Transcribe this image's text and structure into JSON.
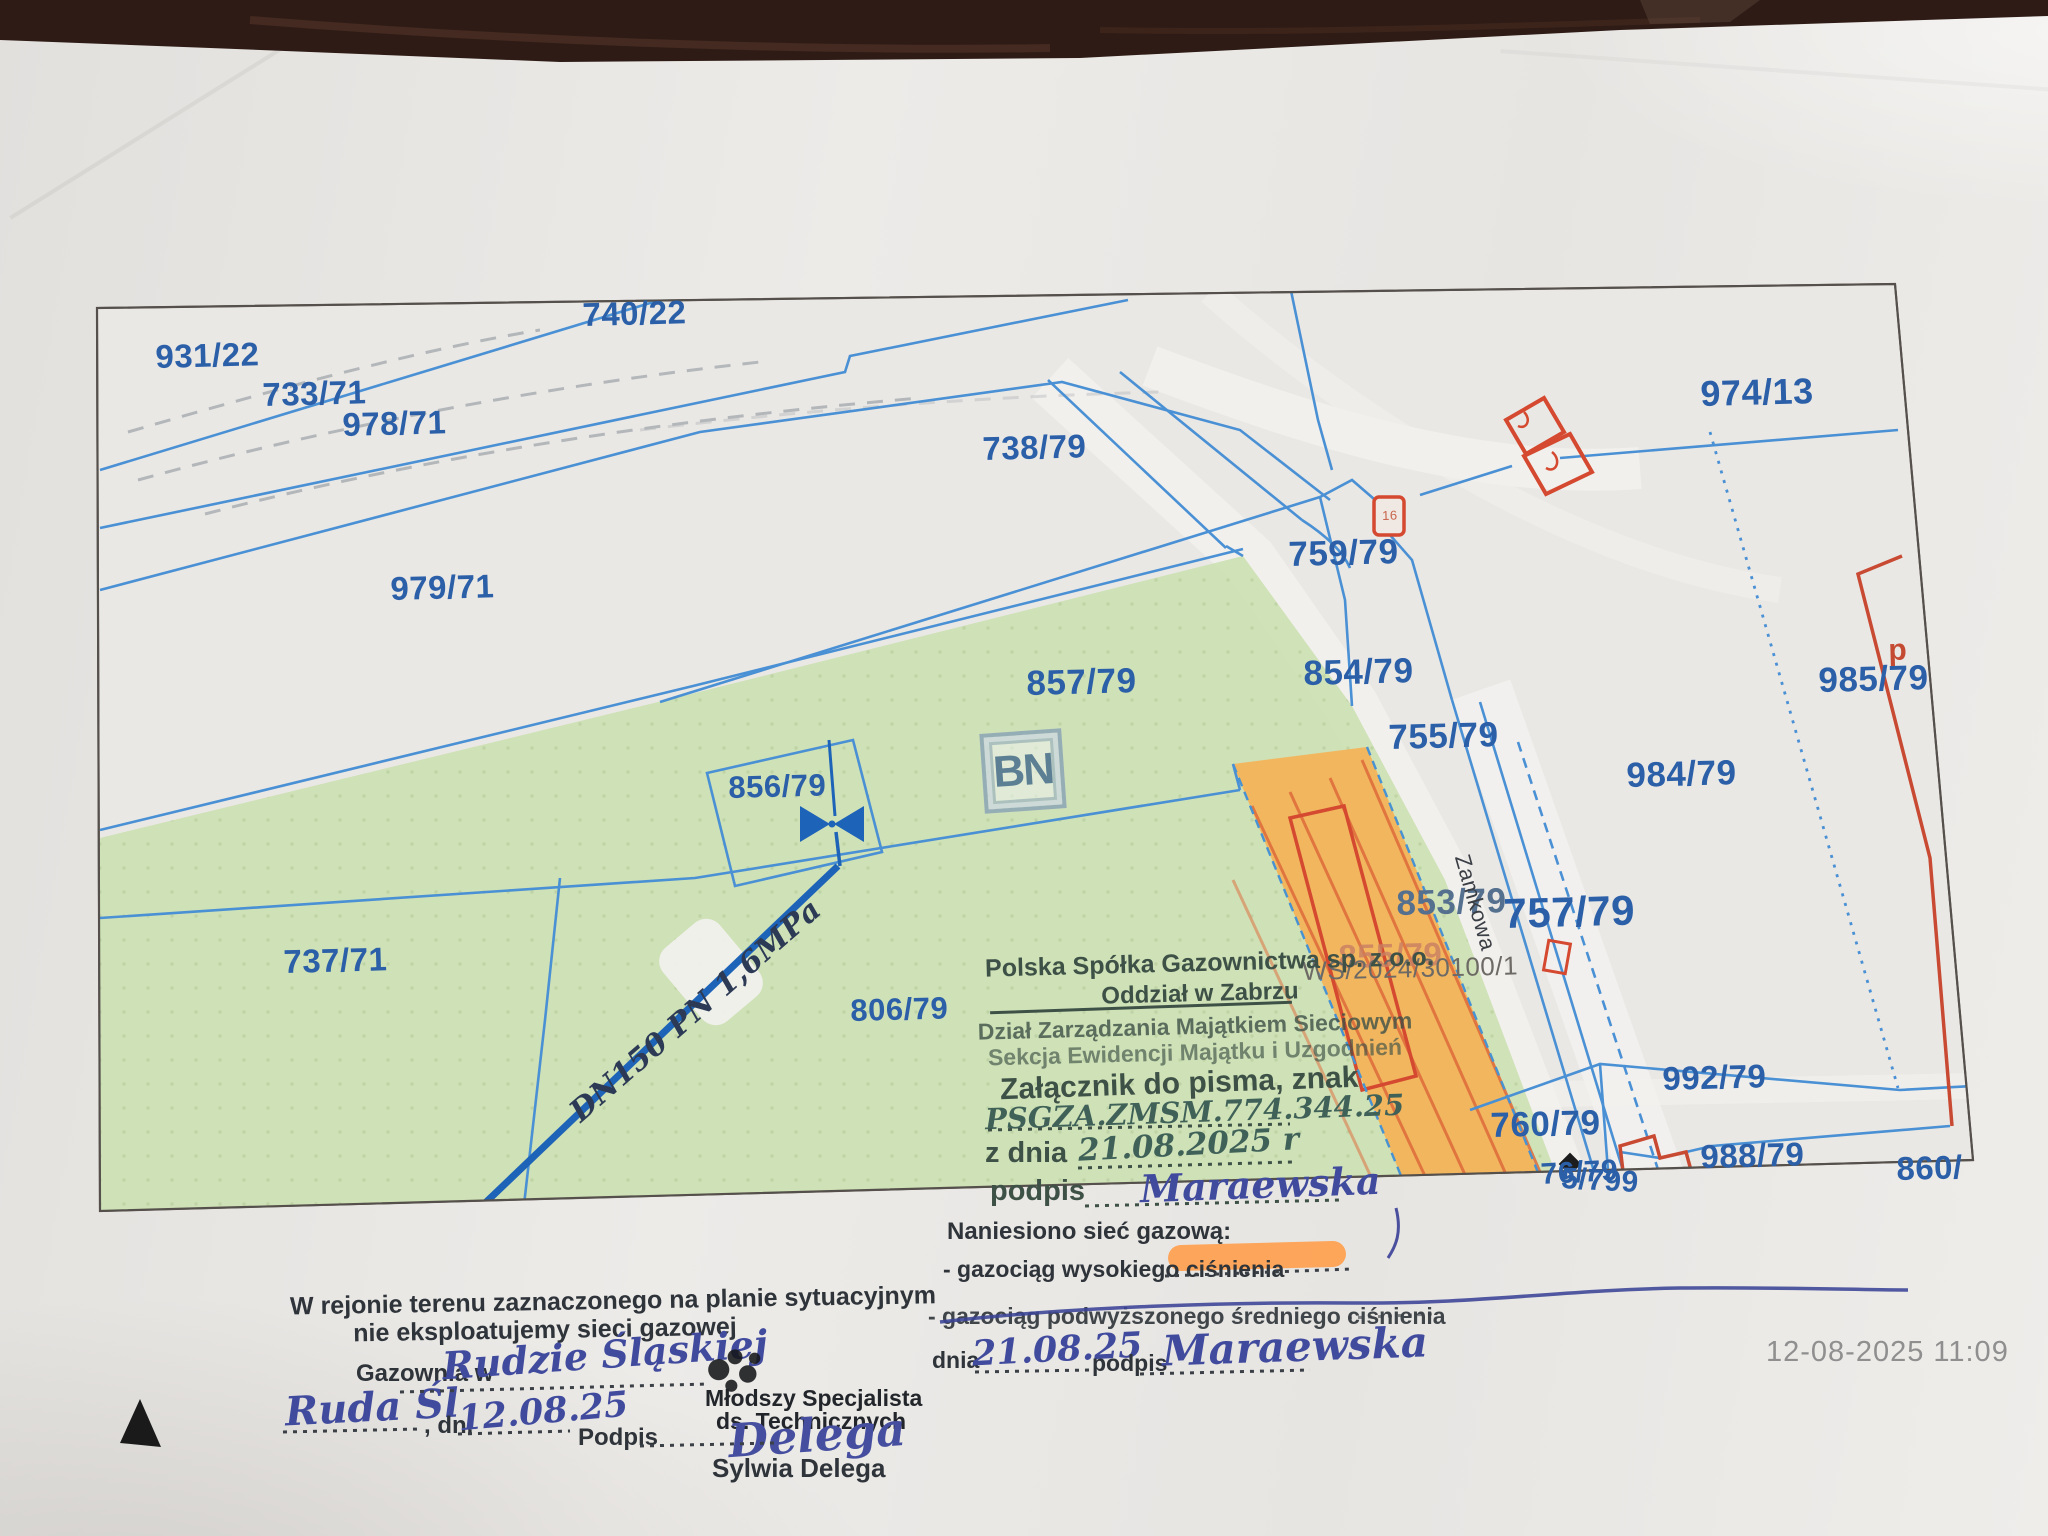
{
  "photo": {
    "timestamp": "12-08-2025 11:09"
  },
  "map": {
    "watermark": "BN",
    "colors": {
      "parcel_line": "#4a90d4",
      "parcel_label": "#2b5fa8",
      "green_area": "#cde0b4",
      "orange_area": "#f3b55c",
      "building_red": "#d4492f",
      "pipeline_blue": "#1d64b8",
      "highlighter": "#ff9d4a"
    },
    "labels": [
      {
        "name": "parcel-931-22",
        "text": "931/22",
        "x": 155,
        "y": 340,
        "size": 33
      },
      {
        "name": "parcel-733-71",
        "text": "733/71",
        "x": 262,
        "y": 378,
        "size": 33
      },
      {
        "name": "parcel-978-71",
        "text": "978/71",
        "x": 342,
        "y": 408,
        "size": 33
      },
      {
        "name": "parcel-740-22",
        "text": "740/22",
        "x": 582,
        "y": 298,
        "size": 33
      },
      {
        "name": "parcel-738-79",
        "text": "738/79",
        "x": 982,
        "y": 432,
        "size": 33
      },
      {
        "name": "parcel-979-71",
        "text": "979/71",
        "x": 390,
        "y": 572,
        "size": 33
      },
      {
        "name": "parcel-857-79",
        "text": "857/79",
        "x": 1026,
        "y": 666,
        "size": 35
      },
      {
        "name": "parcel-759-79",
        "text": "759/79",
        "x": 1288,
        "y": 537,
        "size": 35
      },
      {
        "name": "parcel-854-79",
        "text": "854/79",
        "x": 1303,
        "y": 656,
        "size": 35
      },
      {
        "name": "parcel-755-79",
        "text": "755/79",
        "x": 1388,
        "y": 720,
        "size": 35
      },
      {
        "name": "parcel-974-13",
        "text": "974/13",
        "x": 1700,
        "y": 376,
        "size": 36
      },
      {
        "name": "parcel-985-79",
        "text": "985/79",
        "x": 1818,
        "y": 663,
        "size": 35
      },
      {
        "name": "parcel-984-79",
        "text": "984/79",
        "x": 1626,
        "y": 758,
        "size": 35
      },
      {
        "name": "parcel-856-79",
        "text": "856/79",
        "x": 728,
        "y": 772,
        "size": 31
      },
      {
        "name": "parcel-737-71",
        "text": "737/71",
        "x": 283,
        "y": 945,
        "size": 33
      },
      {
        "name": "parcel-806-79",
        "text": "806/79",
        "x": 850,
        "y": 995,
        "size": 31
      },
      {
        "name": "parcel-853-79",
        "text": "853/79",
        "x": 1396,
        "y": 886,
        "size": 35,
        "color": "#54708e"
      },
      {
        "name": "parcel-855-79",
        "text": "855/79",
        "x": 1338,
        "y": 940,
        "size": 33,
        "color": "#c97f63",
        "opacity": 0.8
      },
      {
        "name": "map-reference",
        "text": "WS/2024/30100/1",
        "x": 1302,
        "y": 958,
        "size": 26,
        "color": "#6d6a66",
        "weight": 0
      },
      {
        "name": "parcel-757-79",
        "text": "757/79",
        "x": 1503,
        "y": 893,
        "size": 42
      },
      {
        "name": "street-zamkowa",
        "text": "Zamkowa",
        "x": 1472,
        "y": 852,
        "size": 22,
        "color": "#3a3e45",
        "rot": 74,
        "weight": 0
      },
      {
        "name": "parcel-992-79",
        "text": "992/79",
        "x": 1662,
        "y": 1062,
        "size": 33
      },
      {
        "name": "parcel-760-79",
        "text": "760/79",
        "x": 1490,
        "y": 1108,
        "size": 35
      },
      {
        "name": "parcel-988-79",
        "text": "988/79",
        "x": 1700,
        "y": 1140,
        "size": 33
      },
      {
        "name": "parcel-860",
        "text": "860/",
        "x": 1896,
        "y": 1152,
        "size": 33
      },
      {
        "name": "parcel-cluster-a",
        "text": "76/79",
        "x": 1540,
        "y": 1160,
        "size": 30,
        "rot": -3
      },
      {
        "name": "parcel-cluster-b",
        "text": "5/799",
        "x": 1562,
        "y": 1164,
        "size": 30,
        "rot": 3
      },
      {
        "name": "hydrant-16-label",
        "text": "16",
        "x": 1382,
        "y": 509,
        "size": 13,
        "color": "#c8654a",
        "weight": 0
      },
      {
        "name": "building-p-label",
        "text": "p",
        "x": 1888,
        "y": 636,
        "size": 30,
        "color": "#c44a32"
      },
      {
        "name": "pipeline-label",
        "text": "DN150 PN 1,6MPa",
        "x": 565,
        "y": 1105,
        "size": 30,
        "rot": -41,
        "hand": 1,
        "color": "#2c3a55"
      }
    ]
  },
  "stamp": {
    "company_line1": "Polska Spółka Gazownictwa sp. z o.o.",
    "company_line2": "Oddział w Zabrzu",
    "dept_line1": "Dział Zarządzania Majątkiem Sieciowym",
    "dept_line2": "Sekcja Ewidencji Majątku i Uzgodnień",
    "attachment_label": "Załącznik do pisma, znak",
    "attachment_ref": "PSGZA.ZMSM.774.344.25",
    "date_label": "z dnia",
    "date_value": "21.08.2025 r",
    "signature_label": "podpis",
    "signature_value": "Maraewska"
  },
  "gas_note": {
    "title": "Naniesiono sieć gazową:",
    "item_high": "- gazociąg wysokiego ciśnienia",
    "item_medium": "- gazociąg podwyższonego średniego ciśnienia",
    "date_label": "dnia",
    "date_value": "21.08.25",
    "signature_label": "podpis",
    "signature_value": "Maraewska"
  },
  "no_network_note": {
    "line1": "W rejonie terenu zaznaczonego na planie sytuacyjnym",
    "line2": "nie eksploatujemy sieci gazowej",
    "office_label": "Gazownia w",
    "office_value": "Rudzie Śląskiej",
    "place_value": "Ruda Śl",
    "date_label": ", dn.",
    "date_value": "12.08.25",
    "signature_label": "Podpis",
    "title_line1": "Młodszy Specjalista",
    "title_line2": "ds. Technicznych",
    "signature_value": "Delega",
    "signer_name": "Sylwia Delega"
  }
}
